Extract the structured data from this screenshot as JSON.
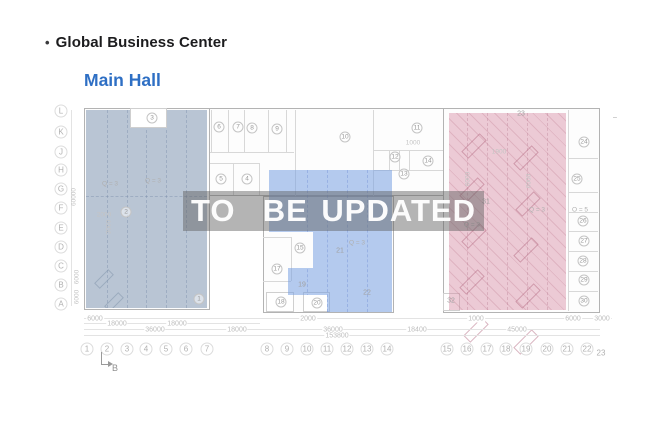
{
  "header": {
    "bullet": "•",
    "title": "Global Business Center",
    "subtitle": "Main Hall"
  },
  "watermark": {
    "text": "TO  BE UPDATED"
  },
  "colors": {
    "subtitle_blue": "#2e6fc4",
    "zone_left": "#b9c5d3",
    "zone_middle": "#b5cbee",
    "zone_right": "#edcbd6",
    "watermark_band": "#aaaaaa",
    "watermark_text": "#ffffff"
  },
  "plan": {
    "rooms_circled": [
      {
        "t": "1",
        "x": 199,
        "y": 299
      },
      {
        "t": "2",
        "x": 126,
        "y": 212
      },
      {
        "t": "3",
        "x": 152,
        "y": 118
      },
      {
        "t": "4",
        "x": 247,
        "y": 179
      },
      {
        "t": "5",
        "x": 221,
        "y": 179
      },
      {
        "t": "6",
        "x": 219,
        "y": 127
      },
      {
        "t": "7",
        "x": 238,
        "y": 127
      },
      {
        "t": "8",
        "x": 252,
        "y": 128
      },
      {
        "t": "9",
        "x": 277,
        "y": 129
      },
      {
        "t": "10",
        "x": 345,
        "y": 137
      },
      {
        "t": "11",
        "x": 417,
        "y": 128
      },
      {
        "t": "12",
        "x": 395,
        "y": 157
      },
      {
        "t": "13",
        "x": 404,
        "y": 174
      },
      {
        "t": "14",
        "x": 428,
        "y": 161
      },
      {
        "t": "15",
        "x": 300,
        "y": 248
      },
      {
        "t": "17",
        "x": 277,
        "y": 269
      },
      {
        "t": "18",
        "x": 281,
        "y": 302
      },
      {
        "t": "20",
        "x": 317,
        "y": 303
      },
      {
        "t": "24",
        "x": 584,
        "y": 142
      },
      {
        "t": "25",
        "x": 577,
        "y": 179
      },
      {
        "t": "26",
        "x": 583,
        "y": 221
      },
      {
        "t": "27",
        "x": 584,
        "y": 241
      },
      {
        "t": "28",
        "x": 583,
        "y": 261
      },
      {
        "t": "29",
        "x": 584,
        "y": 280
      },
      {
        "t": "30",
        "x": 584,
        "y": 301
      }
    ],
    "rooms_plain": [
      {
        "t": "19",
        "x": 302,
        "y": 285
      },
      {
        "t": "21",
        "x": 340,
        "y": 251
      },
      {
        "t": "22",
        "x": 367,
        "y": 293
      },
      {
        "t": "23",
        "x": 521,
        "y": 114
      },
      {
        "t": "31",
        "x": 486,
        "y": 202
      },
      {
        "t": "32",
        "x": 451,
        "y": 301
      },
      {
        "t": "–",
        "x": 615,
        "y": 118
      }
    ],
    "q_labels": [
      {
        "t": "Q = 3",
        "x": 110,
        "y": 184
      },
      {
        "t": "Q = 3",
        "x": 153,
        "y": 181
      },
      {
        "t": "Q = 3",
        "x": 357,
        "y": 243
      },
      {
        "t": "Q = 3",
        "x": 472,
        "y": 225
      },
      {
        "t": "Q = 3",
        "x": 537,
        "y": 210
      },
      {
        "t": "O = 5",
        "x": 580,
        "y": 210
      }
    ],
    "small_dims": [
      {
        "t": "1900",
        "x": 499,
        "y": 152
      },
      {
        "t": "1000",
        "x": 413,
        "y": 143
      },
      {
        "t": "2000",
        "x": 104,
        "y": 215
      },
      {
        "t": "6000",
        "x": 468,
        "y": 179,
        "rot": 1
      },
      {
        "t": "6000",
        "x": 529,
        "y": 181,
        "rot": 1
      },
      {
        "t": "3000",
        "x": 109,
        "y": 227,
        "rot": 1
      }
    ]
  },
  "axes": {
    "rows": [
      {
        "t": "L",
        "x": 61,
        "y": 111
      },
      {
        "t": "K",
        "x": 61,
        "y": 132
      },
      {
        "t": "J",
        "x": 61,
        "y": 152
      },
      {
        "t": "H",
        "x": 61,
        "y": 170
      },
      {
        "t": "G",
        "x": 61,
        "y": 189
      },
      {
        "t": "F",
        "x": 61,
        "y": 208
      },
      {
        "t": "E",
        "x": 61,
        "y": 228
      },
      {
        "t": "D",
        "x": 61,
        "y": 247
      },
      {
        "t": "C",
        "x": 61,
        "y": 266
      },
      {
        "t": "B",
        "x": 61,
        "y": 285
      },
      {
        "t": "A",
        "x": 61,
        "y": 304
      }
    ],
    "cols": [
      {
        "t": "1",
        "x": 87,
        "y": 349
      },
      {
        "t": "2",
        "x": 107,
        "y": 349
      },
      {
        "t": "3",
        "x": 127,
        "y": 349
      },
      {
        "t": "4",
        "x": 146,
        "y": 349
      },
      {
        "t": "5",
        "x": 166,
        "y": 349
      },
      {
        "t": "6",
        "x": 186,
        "y": 349
      },
      {
        "t": "7",
        "x": 207,
        "y": 349
      },
      {
        "t": "8",
        "x": 267,
        "y": 349
      },
      {
        "t": "9",
        "x": 287,
        "y": 349
      },
      {
        "t": "10",
        "x": 307,
        "y": 349
      },
      {
        "t": "11",
        "x": 327,
        "y": 349
      },
      {
        "t": "12",
        "x": 347,
        "y": 349
      },
      {
        "t": "13",
        "x": 367,
        "y": 349
      },
      {
        "t": "14",
        "x": 387,
        "y": 349
      },
      {
        "t": "15",
        "x": 447,
        "y": 349
      },
      {
        "t": "16",
        "x": 467,
        "y": 349
      },
      {
        "t": "17",
        "x": 487,
        "y": 349
      },
      {
        "t": "18",
        "x": 506,
        "y": 349
      },
      {
        "t": "19",
        "x": 526,
        "y": 349
      },
      {
        "t": "20",
        "x": 547,
        "y": 349
      },
      {
        "t": "21",
        "x": 567,
        "y": 349
      },
      {
        "t": "22",
        "x": 587,
        "y": 349
      }
    ],
    "col_23": {
      "t": "23",
      "x": 601,
      "y": 353
    },
    "left_dims": [
      {
        "t": "60000",
        "x": 74,
        "y": 197,
        "rot": 1
      },
      {
        "t": "6000",
        "x": 77,
        "y": 277,
        "rot": 1
      },
      {
        "t": "6000",
        "x": 77,
        "y": 297,
        "rot": 1
      }
    ],
    "marker_b": "B"
  },
  "dims": [
    {
      "t": "6000",
      "x": 95,
      "y": 319
    },
    {
      "t": "2000",
      "x": 308,
      "y": 319
    },
    {
      "t": "1000",
      "x": 476,
      "y": 319
    },
    {
      "t": "6000",
      "x": 573,
      "y": 319
    },
    {
      "t": "3000",
      "x": 602,
      "y": 319
    },
    {
      "t": "18000",
      "x": 117,
      "y": 324
    },
    {
      "t": "18000",
      "x": 177,
      "y": 324
    },
    {
      "t": "36000",
      "x": 155,
      "y": 330
    },
    {
      "t": "18000",
      "x": 237,
      "y": 330
    },
    {
      "t": "36000",
      "x": 333,
      "y": 330
    },
    {
      "t": "18400",
      "x": 417,
      "y": 330
    },
    {
      "t": "45000",
      "x": 517,
      "y": 330
    },
    {
      "t": "153800",
      "x": 337,
      "y": 336
    }
  ]
}
